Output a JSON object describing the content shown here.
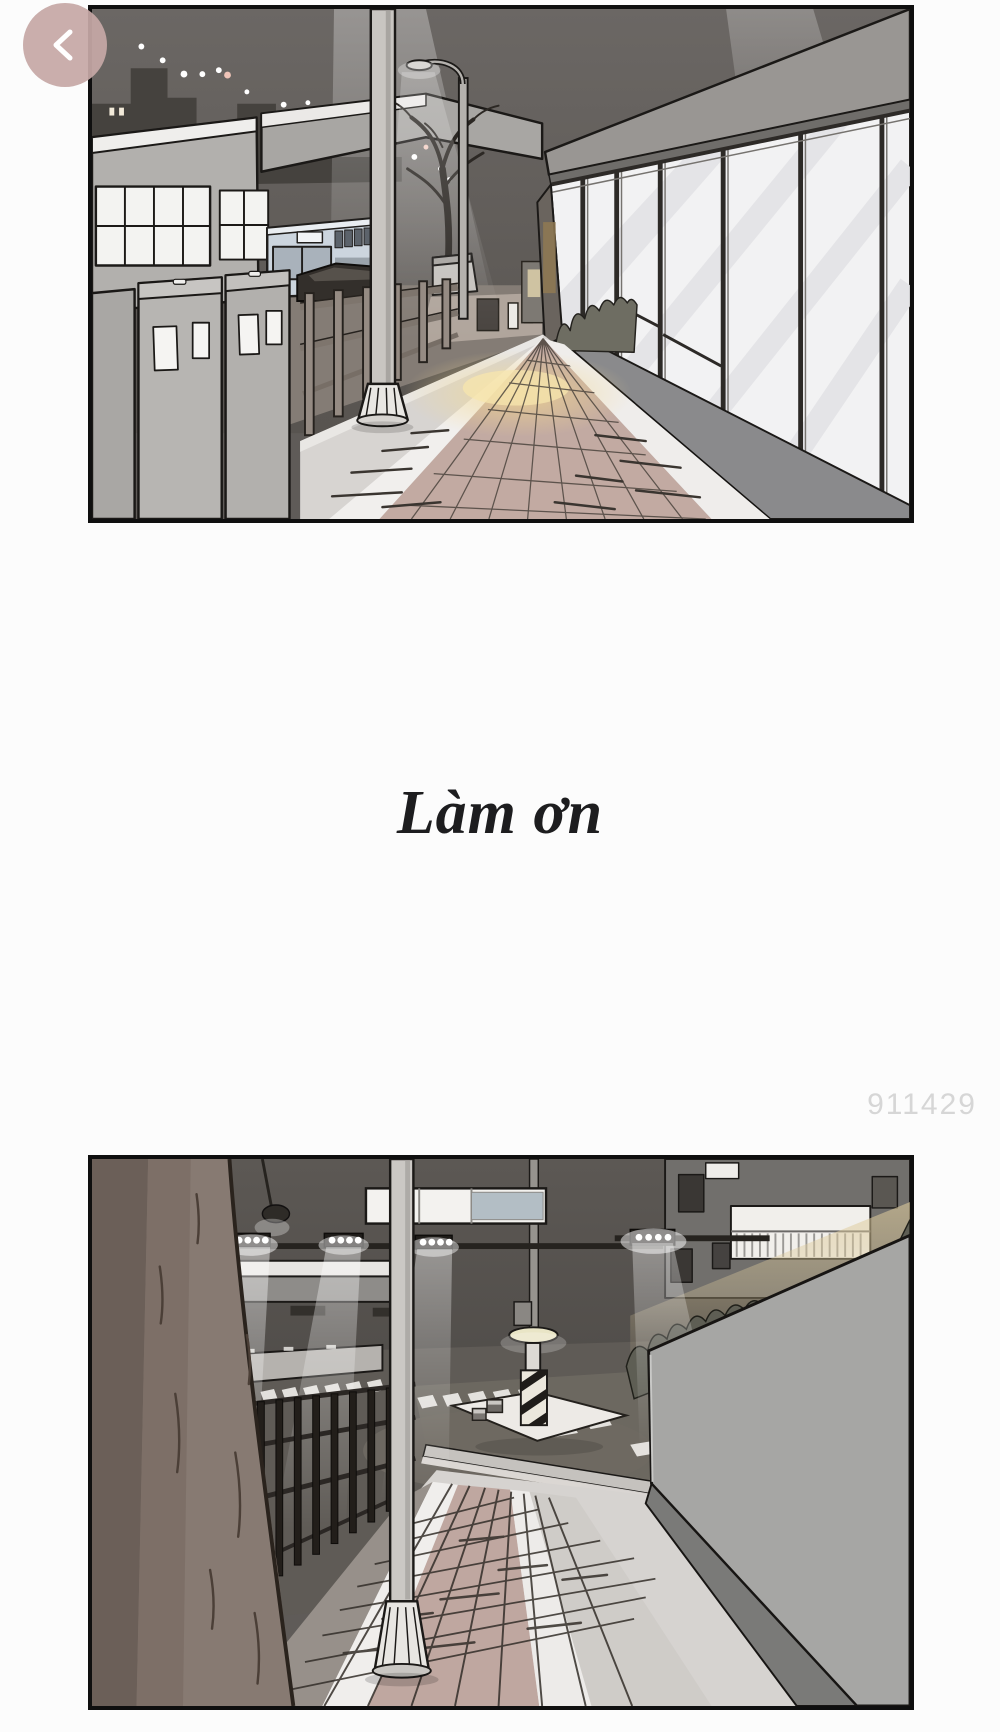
{
  "page": {
    "background": "#fcfcfc"
  },
  "reader": {
    "back_button": {
      "icon": "chevron-left-icon",
      "color": "#c6a8a6"
    },
    "watermark": {
      "text": "911429",
      "color": "#d6d6d6"
    }
  },
  "comic": {
    "caption": {
      "text": "Làm ơn",
      "color": "#1d1d1f"
    },
    "panels": [
      {
        "id": "panel-1",
        "alt": "Night city sidewalk: storefront glass windows on the right, utility cabinets, parked bus, guardrail, street lamp and utility pole, warm light on tiled pavement"
      },
      {
        "id": "panel-2",
        "alt": "Night street corner: large tree trunk in foreground, black metal fence, floodlit crosswalk with striped toll pillar, utility pole and tall concrete wall topped by a hedge"
      }
    ]
  }
}
